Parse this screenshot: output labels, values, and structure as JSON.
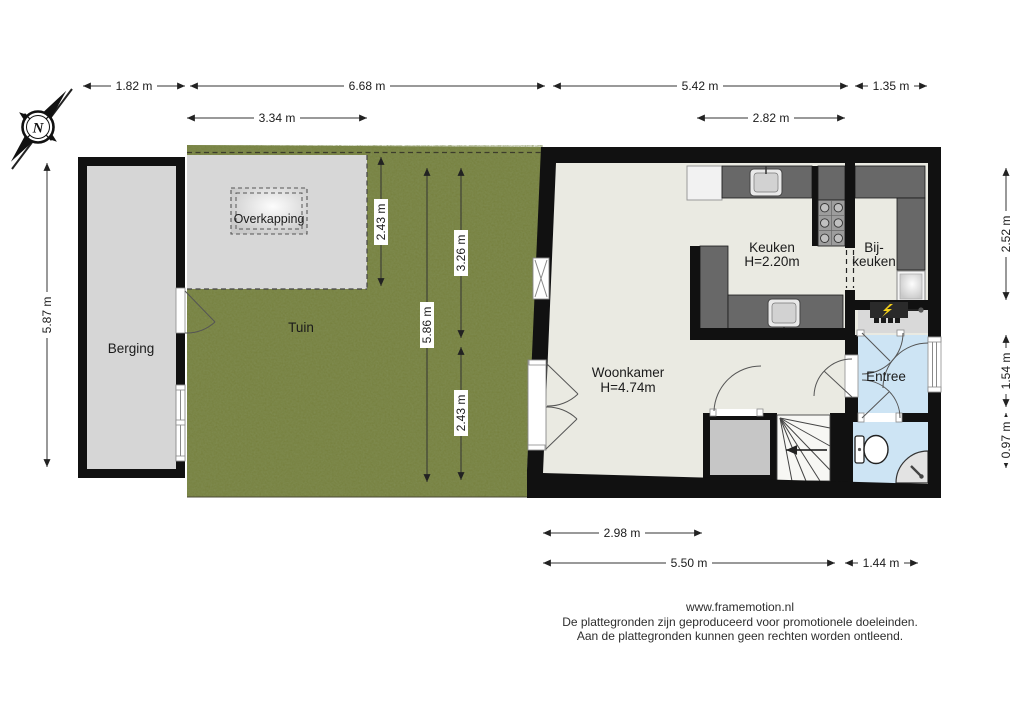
{
  "compass": {
    "north_label": "N"
  },
  "rooms": {
    "berging": {
      "label": "Berging"
    },
    "tuin": {
      "label": "Tuin"
    },
    "overkapping": {
      "label": "Overkapping"
    },
    "woonkamer": {
      "label": "Woonkamer",
      "ceiling_height": "H=4.74m"
    },
    "keuken": {
      "label": "Keuken",
      "ceiling_height": "H=2.20m"
    },
    "bijkeuken": {
      "label_line1": "Bij-",
      "label_line2": "keuken"
    },
    "entree": {
      "label": "Entree"
    }
  },
  "dimensions": {
    "top_row": [
      "1.82 m",
      "6.68 m",
      "5.42 m",
      "1.35 m"
    ],
    "second_row": [
      "3.34 m",
      "2.82 m"
    ],
    "left": [
      "5.87 m"
    ],
    "right": [
      "2.52 m",
      "1.54 m",
      "0.97 m"
    ],
    "garden_vertical": [
      "2.43 m",
      "5.86 m",
      "3.26 m",
      "2.43 m"
    ],
    "bottom_row": [
      "2.98 m",
      "5.50 m",
      "1.44 m"
    ]
  },
  "footer": {
    "website": "www.framemotion.nl",
    "disclaimer_line1": "De plattegronden zijn geproduceerd voor promotionele doeleinden.",
    "disclaimer_line2": "Aan de plattegronden kunnen geen rechten worden ontleend."
  },
  "colors": {
    "wall": "#111111",
    "floor": "#eaeae2",
    "wet_room_floor": "#cde4f4",
    "counter": "#686868",
    "grass": "#76803e",
    "paving": "#d7d7d7",
    "meter_bolt": "#f2cf1b"
  }
}
